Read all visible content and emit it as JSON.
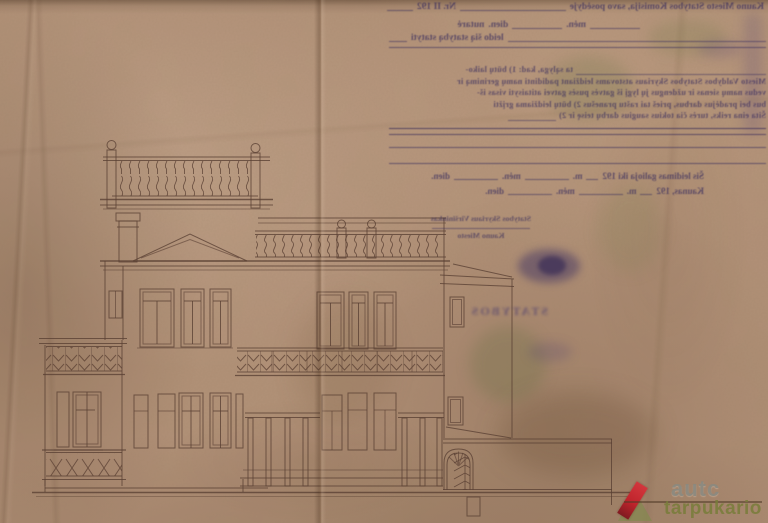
{
  "document_kind": "scanned building permit with facade elevation drawing",
  "colors": {
    "paper": "#b29178",
    "drawing_ink": "#5a4033",
    "stamp_ink": "#32285c",
    "watermark_accent": "#c0242c",
    "watermark_brand_color": "#8a897f",
    "watermark_subtitle_color": "#787c3a"
  },
  "permit": {
    "header": "Kauno Miesto Statybos Komisija, savo posėdyje",
    "header_no": "Nr. II 192",
    "resolved": "nutarė",
    "grant": "leido šią statybą statyti",
    "labels": {
      "m": "m.",
      "men": "mėn.",
      "dien": "dien."
    },
    "conditions": [
      "ta sąlyga, kad: 1) būtų laiko-",
      "Miesto Valdybos Statybos Skyriaus atstovams leidžiant padidinti namų gerinimą ir",
      "vedus namų sienas ir uždengus jų lygį iš gatvės pusės gatvei atitaisyti visas iš-",
      "bus bei pradėjus darbus, prieš tai raštu pranešus 2) būtų leidžiama grįžti",
      "Šita eina reiks, turės čia tokius saugius darbų teisę ir 2)"
    ],
    "validity": "Šis leidimas galioja iki 192",
    "city": "Kaunas, 192",
    "stamp_title": "Statybos Skyriaus Viršininkas",
    "stamp_sub": "Kauno Miesto",
    "faint_word": "STATYBOS"
  },
  "watermark": {
    "brand": "autc",
    "subtitle": "tarpukario"
  }
}
